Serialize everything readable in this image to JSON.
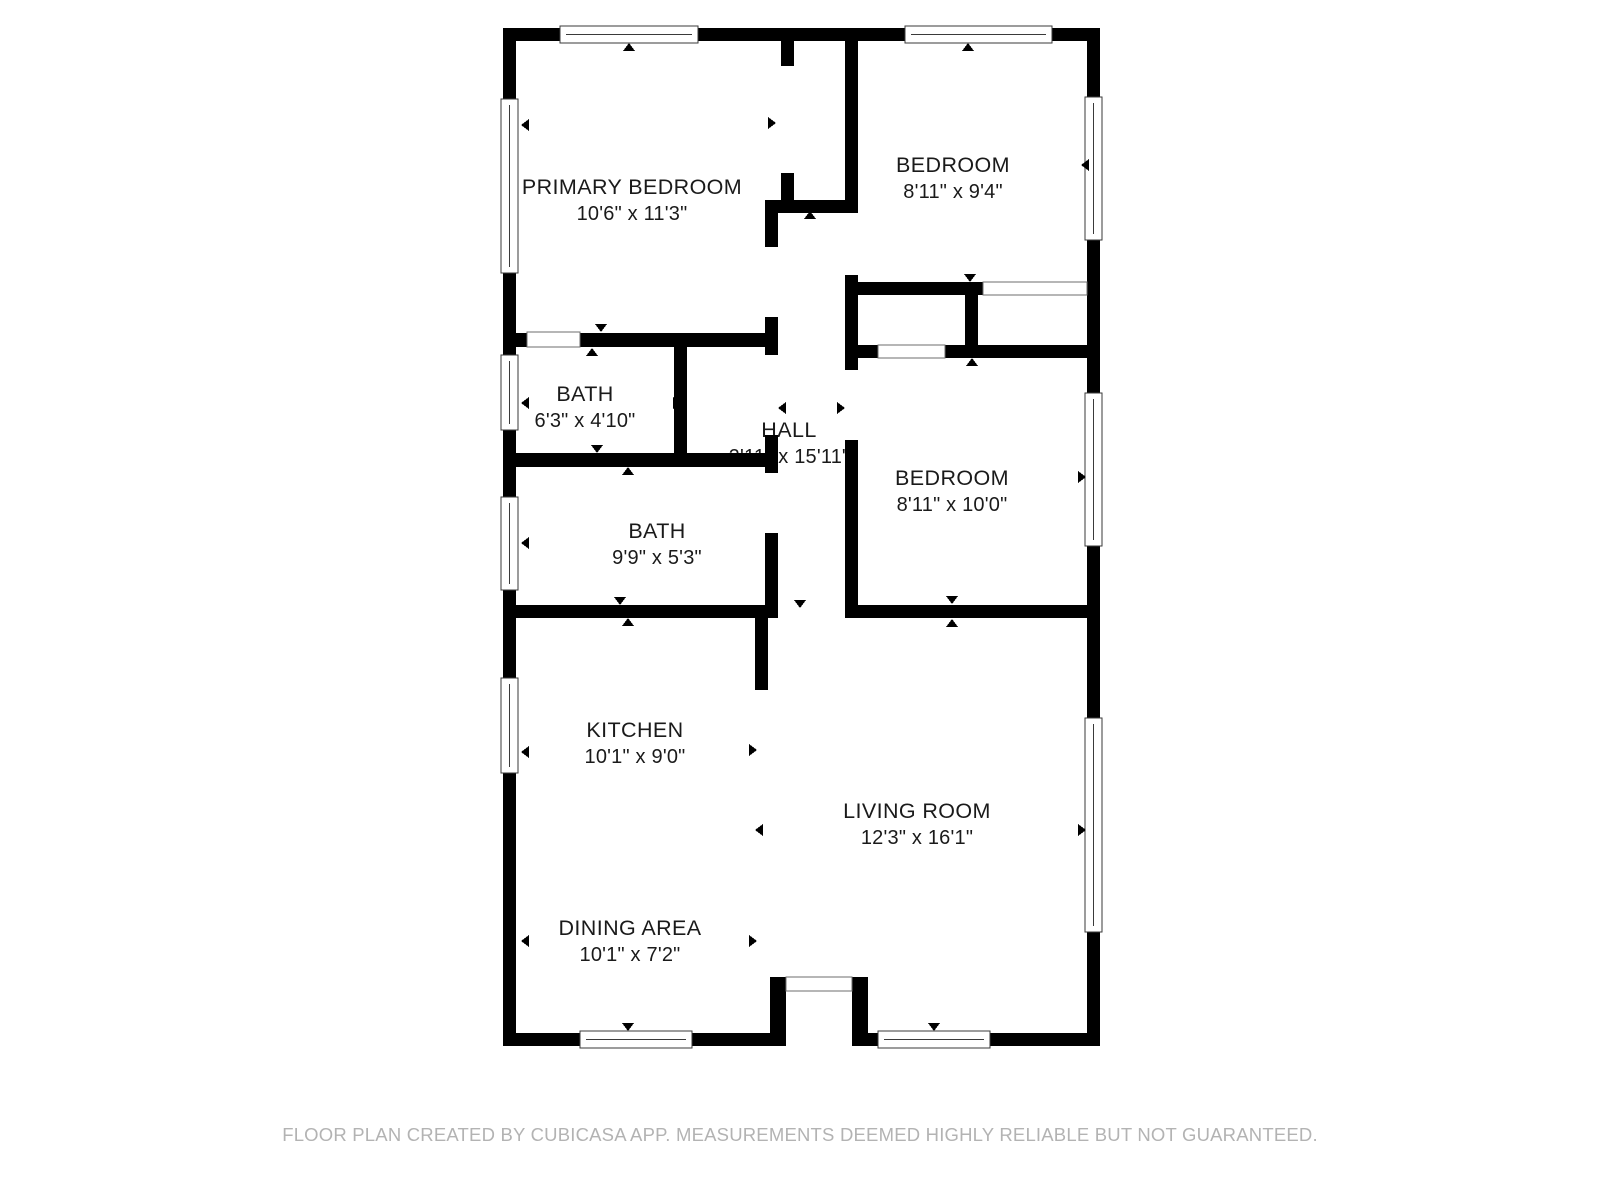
{
  "rooms": [
    {
      "name": "PRIMARY BEDROOM",
      "dims": "10'6\" x 11'3\""
    },
    {
      "name": "BEDROOM",
      "dims": "8'11\" x 9'4\""
    },
    {
      "name": "BATH",
      "dims": "6'3\" x 4'10\""
    },
    {
      "name": "HALL",
      "dims": "2'11\" x 15'11\""
    },
    {
      "name": "BEDROOM",
      "dims": "8'11\" x 10'0\""
    },
    {
      "name": "BATH",
      "dims": "9'9\" x 5'3\""
    },
    {
      "name": "KITCHEN",
      "dims": "10'1\" x 9'0\""
    },
    {
      "name": "LIVING ROOM",
      "dims": "12'3\" x 16'1\""
    },
    {
      "name": "DINING AREA",
      "dims": "10'1\" x 7'2\""
    }
  ],
  "footer": {
    "disclaimer": "FLOOR PLAN CREATED BY CUBICASA APP. MEASUREMENTS DEEMED HIGHLY RELIABLE BUT NOT GUARANTEED."
  },
  "colors": {
    "wall": "#000000",
    "label_text": "#1a1a1a",
    "footer_text": "#b3b3b3",
    "background": "#ffffff"
  }
}
